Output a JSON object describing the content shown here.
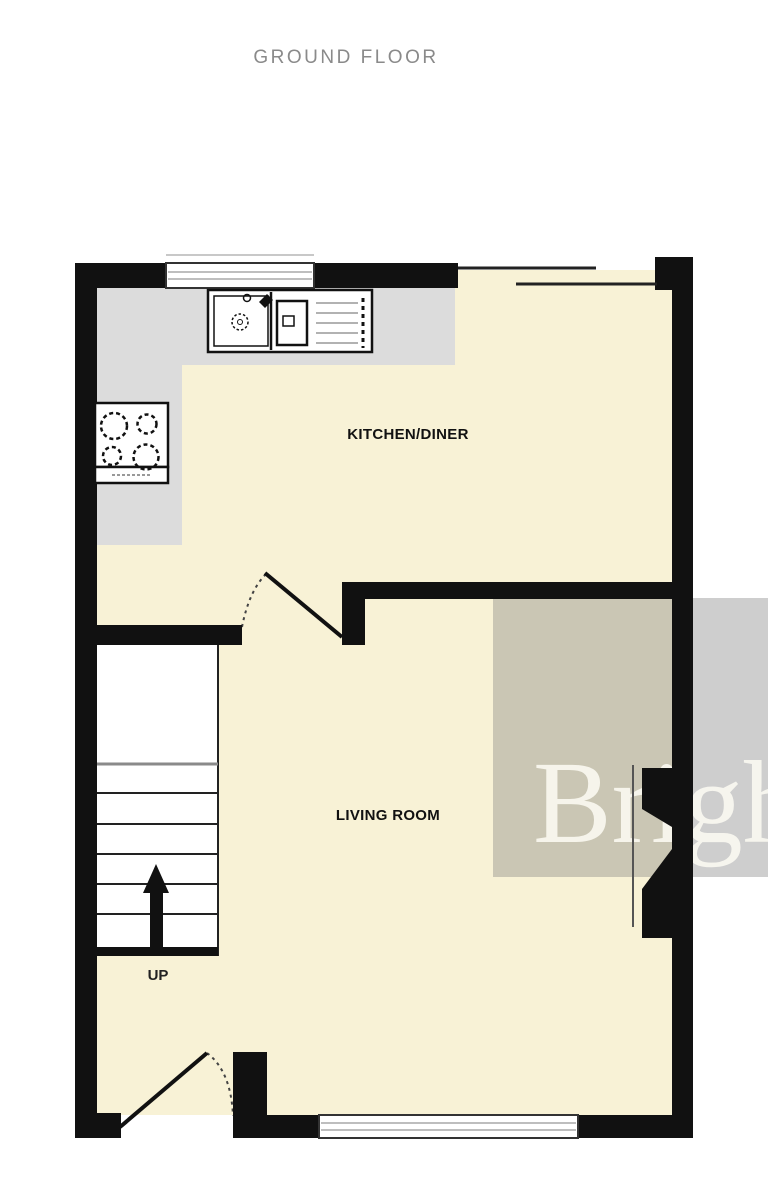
{
  "page": {
    "title": "GROUND FLOOR",
    "background": "#ffffff"
  },
  "floor_plan": {
    "rooms": [
      {
        "label": "KITCHEN/DINER"
      },
      {
        "label": "LIVING ROOM"
      }
    ],
    "stairs": {
      "direction_label": "UP"
    },
    "watermark": {
      "text": "Bright",
      "overlay_color": "#7d7d7d",
      "text_color": "#faf8f0"
    },
    "colors": {
      "floor": "#f8f2d6",
      "counter": "#dcdcdc",
      "wall": "#111111",
      "stairs_fill": "#ffffff",
      "window_line": "#a8a8a8",
      "title_text": "#8a8a8a",
      "label_text": "#111111"
    }
  }
}
